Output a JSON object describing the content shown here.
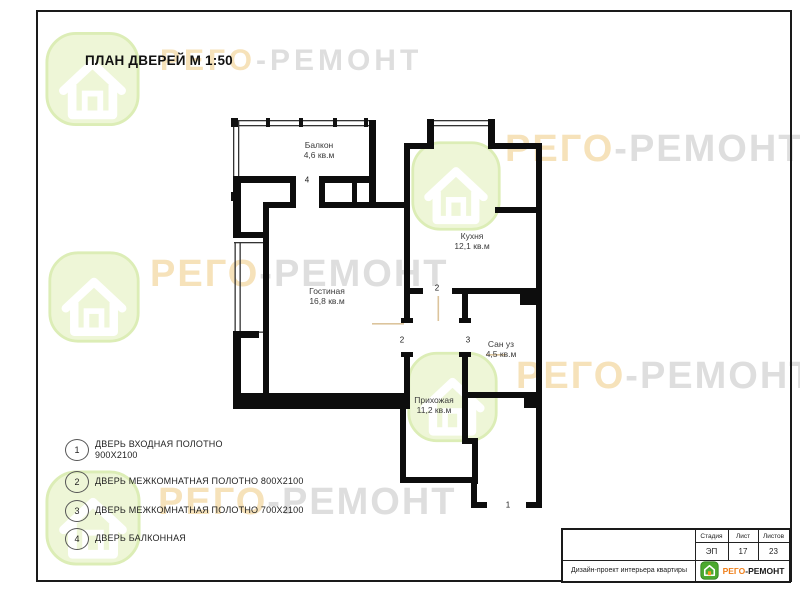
{
  "sheet": {
    "title": "ПЛАН ДВЕРЕЙ М 1:50"
  },
  "watermark": {
    "brand_first": "РЕГО",
    "brand_rest": "-РЕМОНТ",
    "orange": "#f6e2ba",
    "gray": "#dedede",
    "house_green": "#dcedb6"
  },
  "plan": {
    "rooms": [
      {
        "name": "Балкон",
        "area": "4,6 кв.м"
      },
      {
        "name": "Кухня",
        "area": "12,1 кв.м"
      },
      {
        "name": "Гостиная",
        "area": "16,8 кв.м"
      },
      {
        "name": "Сан уз",
        "area": "4,5 кв.м"
      },
      {
        "name": "Прихожая",
        "area": "11,2 кв.м"
      }
    ],
    "door_markers": [
      {
        "num": "4"
      },
      {
        "num": "2"
      },
      {
        "num": "2"
      },
      {
        "num": "3"
      },
      {
        "num": "1"
      }
    ]
  },
  "legend": {
    "items": [
      {
        "num": "1",
        "label": "ДВЕРЬ ВХОДНАЯ ПОЛОТНО",
        "label2": "900Х2100"
      },
      {
        "num": "2",
        "label": "ДВЕРЬ МЕЖКОМНАТНАЯ ПОЛОТНО 800Х2100"
      },
      {
        "num": "3",
        "label": "ДВЕРЬ МЕЖКОМНАТНАЯ ПОЛОТНО 700Х2100"
      },
      {
        "num": "4",
        "label": "ДВЕРЬ БАЛКОННАЯ"
      }
    ]
  },
  "title_block": {
    "stage_label": "Стадия",
    "sheet_label": "Лист",
    "sheets_label": "Листов",
    "stage_value": "ЭП",
    "sheet_value": "17",
    "sheets_value": "23",
    "project": "Дизайн-проект интерьера квартиры",
    "brand_first": "РЕГО",
    "brand_rest": "-РЕМОНТ",
    "logo_green": "#4ba82e",
    "logo_orange": "#f59a1a"
  }
}
